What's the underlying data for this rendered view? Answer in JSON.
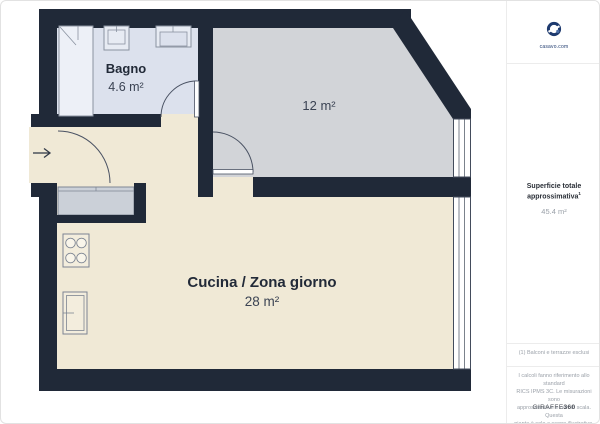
{
  "rooms": {
    "bagno": {
      "name": "Bagno",
      "area": "4.6 m²"
    },
    "camera": {
      "area": "12 m²"
    },
    "cucina": {
      "name": "Cucina / Zona giorno",
      "area": "28 m²"
    }
  },
  "sidebar": {
    "logo_caption": "casavo.com",
    "total_label_line1": "Superficie totale",
    "total_label_line2": "approssimativa",
    "total_footnote_mark": "1",
    "total_value": "45.4 m²",
    "footnote": "(1) Balconi e terrazze esclusi",
    "disclaimer_lines": [
      "I calcoli fanno riferimento allo standard",
      "RICS IPMS 3C. Le misurazioni sono",
      "approssimative e non in scala. Questa",
      "pianta è solo a scopo illustrativo."
    ],
    "brand": "GIRAFFE",
    "brand_suffix": "360"
  },
  "colors": {
    "wall": "#202938",
    "bagno_floor": "#dce1ed",
    "camera_floor": "#d2d4d8",
    "cucina_floor": "#f0e9d6",
    "fixture_stroke": "#7c8492",
    "logo_blue": "#1e3a6e"
  }
}
